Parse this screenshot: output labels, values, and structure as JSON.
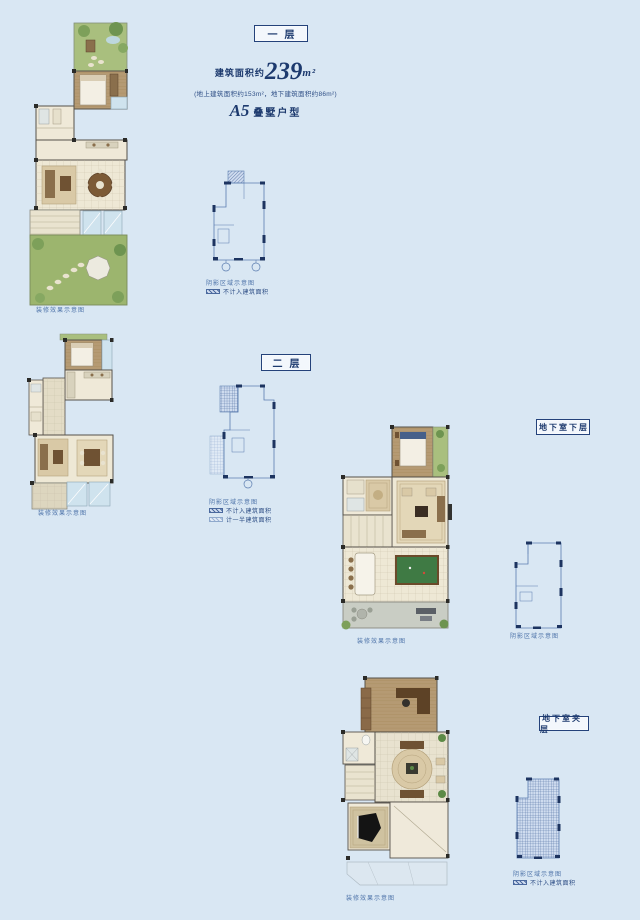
{
  "document": {
    "bg_color": "#d9e7f3",
    "accent_navy": "#1d3a6e",
    "keyplan_blue": "#5b7db0",
    "caption_blue": "#4f74aa",
    "garden_green": "#9cb56e",
    "wood_tan": "#b59a73",
    "floor_cream": "#eee8d5",
    "glass_blue": "#cfe3ee",
    "billiard_green": "#3f7a44"
  },
  "header": {
    "area_prefix": "建筑面积约",
    "area_value": "239",
    "area_unit": "m²",
    "area_detail": "(地上建筑面积约153m²，地下建筑面积约86m²)",
    "unit_model": "A5",
    "unit_type": "叠墅户型"
  },
  "floor1": {
    "label": "一层",
    "plan_caption": "装修效果示意图",
    "keyplan_caption": "阴影区域示意图",
    "legend_no_count": "不计入建筑面积"
  },
  "floor2": {
    "label": "二层",
    "plan_caption": "装修效果示意图",
    "keyplan_caption": "阴影区域示意图",
    "legend_no_count": "不计入建筑面积",
    "legend_half_count": "计一半建筑面积"
  },
  "basement_lower": {
    "label": "地下室下层",
    "plan_caption": "装修效果示意图",
    "keyplan_caption": "阴影区域示意图"
  },
  "basement_mezz": {
    "label": "地下室夹层",
    "plan_caption": "装修效果示意图",
    "keyplan_caption": "阴影区域示意图",
    "legend_no_count": "不计入建筑面积"
  }
}
